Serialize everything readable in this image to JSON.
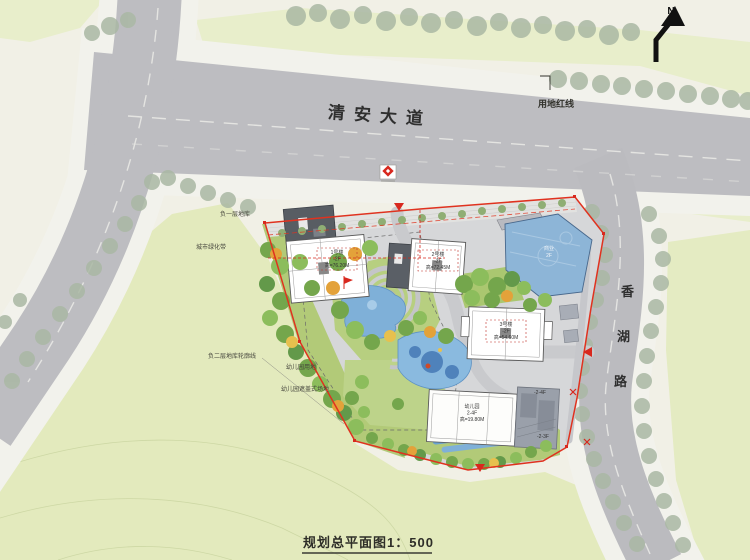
{
  "meta": {
    "drawing_title": "规划总平面图1：500",
    "north_label": "N"
  },
  "roads": {
    "main_road": "清安大道",
    "east_road_chars": [
      "香",
      "湖",
      "路"
    ],
    "red_line_label": "用地红线"
  },
  "annotations": {
    "basement1": "负一层地库",
    "green_belt": "城市绿化带",
    "basement2_outline": "负二层地库轮廓线",
    "kindergarten_land": "幼儿园用地",
    "kindergarten_canopy": "幼儿园遮盖式场地"
  },
  "buildings": {
    "b1": {
      "name": "1号楼",
      "floors": "-2F",
      "height": "高=76.20M"
    },
    "b2": {
      "name": "2号楼",
      "floors": "-2F",
      "height": "高=72.45M"
    },
    "b3": {
      "name": "3号楼",
      "floors": "-2F",
      "height": "高=54.60M"
    },
    "kindergarten": {
      "name": "幼儿园",
      "floors": "2-4F",
      "height": "高=19.80M"
    },
    "commercial": {
      "name": "商业",
      "floors": "2F"
    },
    "annex_tags": {
      "tag_upper": "-2-4F",
      "tag_lower": "-2-3F"
    }
  },
  "colors": {
    "boundary_red": "#e0321f",
    "road_gray": "#bdbdc1",
    "sidewalk": "#f1f1ed",
    "parcel_green": "#e6ecc4",
    "site_lawn": "#b5cc7e",
    "water_blue": "#7fb0d8",
    "roof_blue": "#8db5d7"
  }
}
